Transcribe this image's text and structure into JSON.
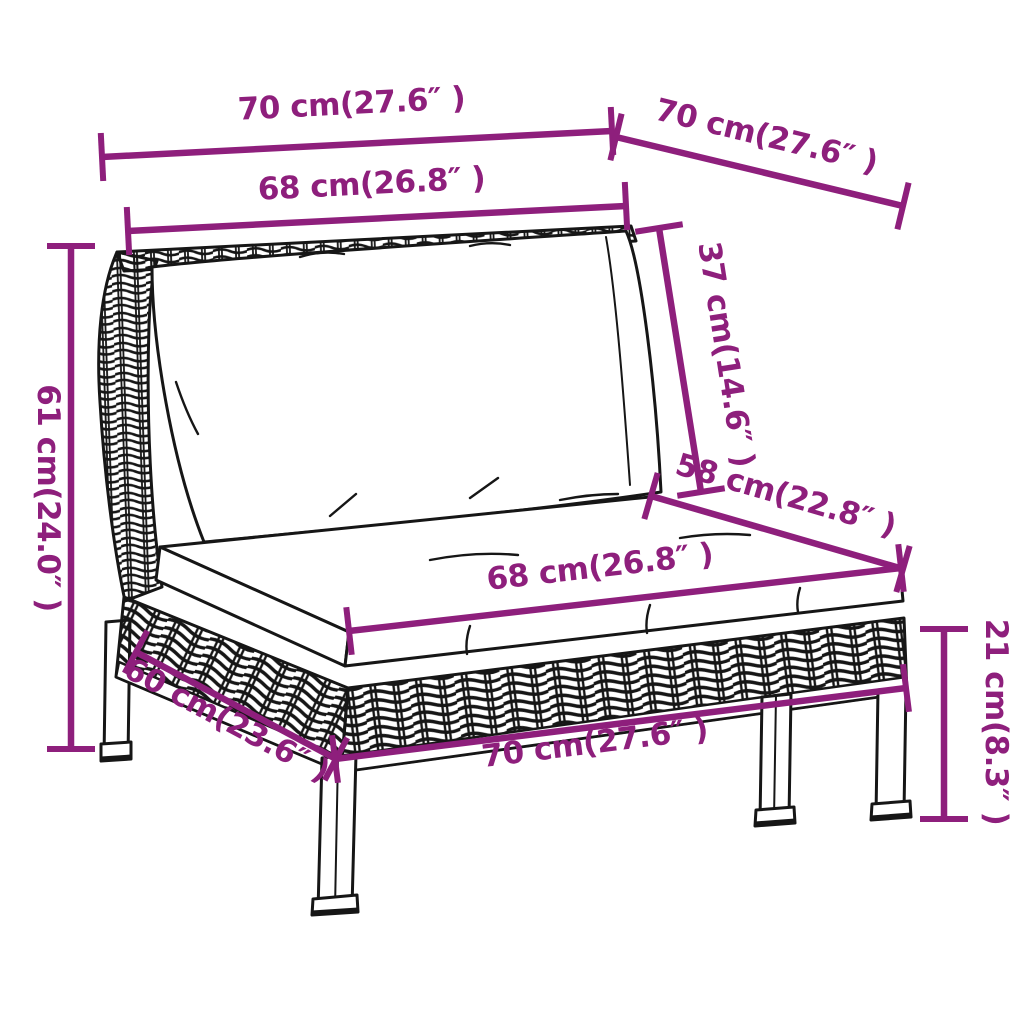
{
  "diagram": {
    "illustration": "rattan garden sofa section with back cushion and seat cushion",
    "accent_color": "#8e1f7c",
    "line_color": "#161616",
    "background_color": "#ffffff",
    "dimensions": [
      {
        "id": "top-width",
        "label": "70 cm(27.6″ )",
        "cm": 70,
        "inches": "27.6"
      },
      {
        "id": "top-depth",
        "label": "70 cm(27.6″ )",
        "cm": 70,
        "inches": "27.6"
      },
      {
        "id": "backrest-cushion-width",
        "label": "68 cm(26.8″ )",
        "cm": 68,
        "inches": "26.8"
      },
      {
        "id": "backrest-cushion-height",
        "label": "37 cm(14.6″ )",
        "cm": 37,
        "inches": "14.6"
      },
      {
        "id": "total-height",
        "label": "61 cm(24.0″ )",
        "cm": 61,
        "inches": "24.0"
      },
      {
        "id": "seat-depth",
        "label": "58 cm(22.8″ )",
        "cm": 58,
        "inches": "22.8"
      },
      {
        "id": "seat-cushion-width",
        "label": "68 cm(26.8″ )",
        "cm": 68,
        "inches": "26.8"
      },
      {
        "id": "base-depth",
        "label": "60 cm(23.6″ )",
        "cm": 60,
        "inches": "23.6"
      },
      {
        "id": "base-width",
        "label": "70 cm(27.6″ )",
        "cm": 70,
        "inches": "27.6"
      },
      {
        "id": "leg-height",
        "label": "21 cm(8.3″ )",
        "cm": 21,
        "inches": "8.3"
      }
    ]
  }
}
